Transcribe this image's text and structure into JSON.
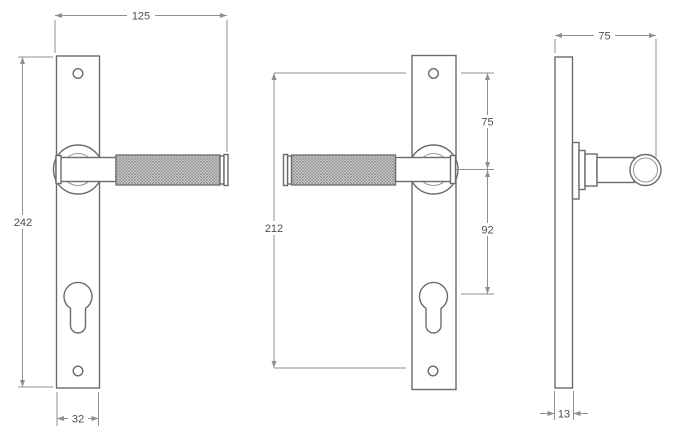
{
  "drawing": {
    "type": "technical-dimension-drawing",
    "subject": "lever-door-handle-on-narrow-backplate",
    "views": [
      "front-view-handle-right",
      "front-view-handle-left",
      "side-profile-view"
    ]
  },
  "dims": {
    "overall_width": "125",
    "plate_height": "242",
    "plate_width": "32",
    "screw_centres": "212",
    "screw_to_handle": "75",
    "handle_to_cylinder": "92",
    "side_projection": "75",
    "plate_thickness": "13"
  },
  "colors": {
    "background": "#ffffff",
    "outline": "#6b6b6b",
    "inner_line": "#9a9a9a",
    "dimension_line": "#8f8f8f",
    "label_text": "#4d4d4d",
    "knurl_fill": "#d7d7d7",
    "knurl_hatch": "#8e8e8e"
  }
}
